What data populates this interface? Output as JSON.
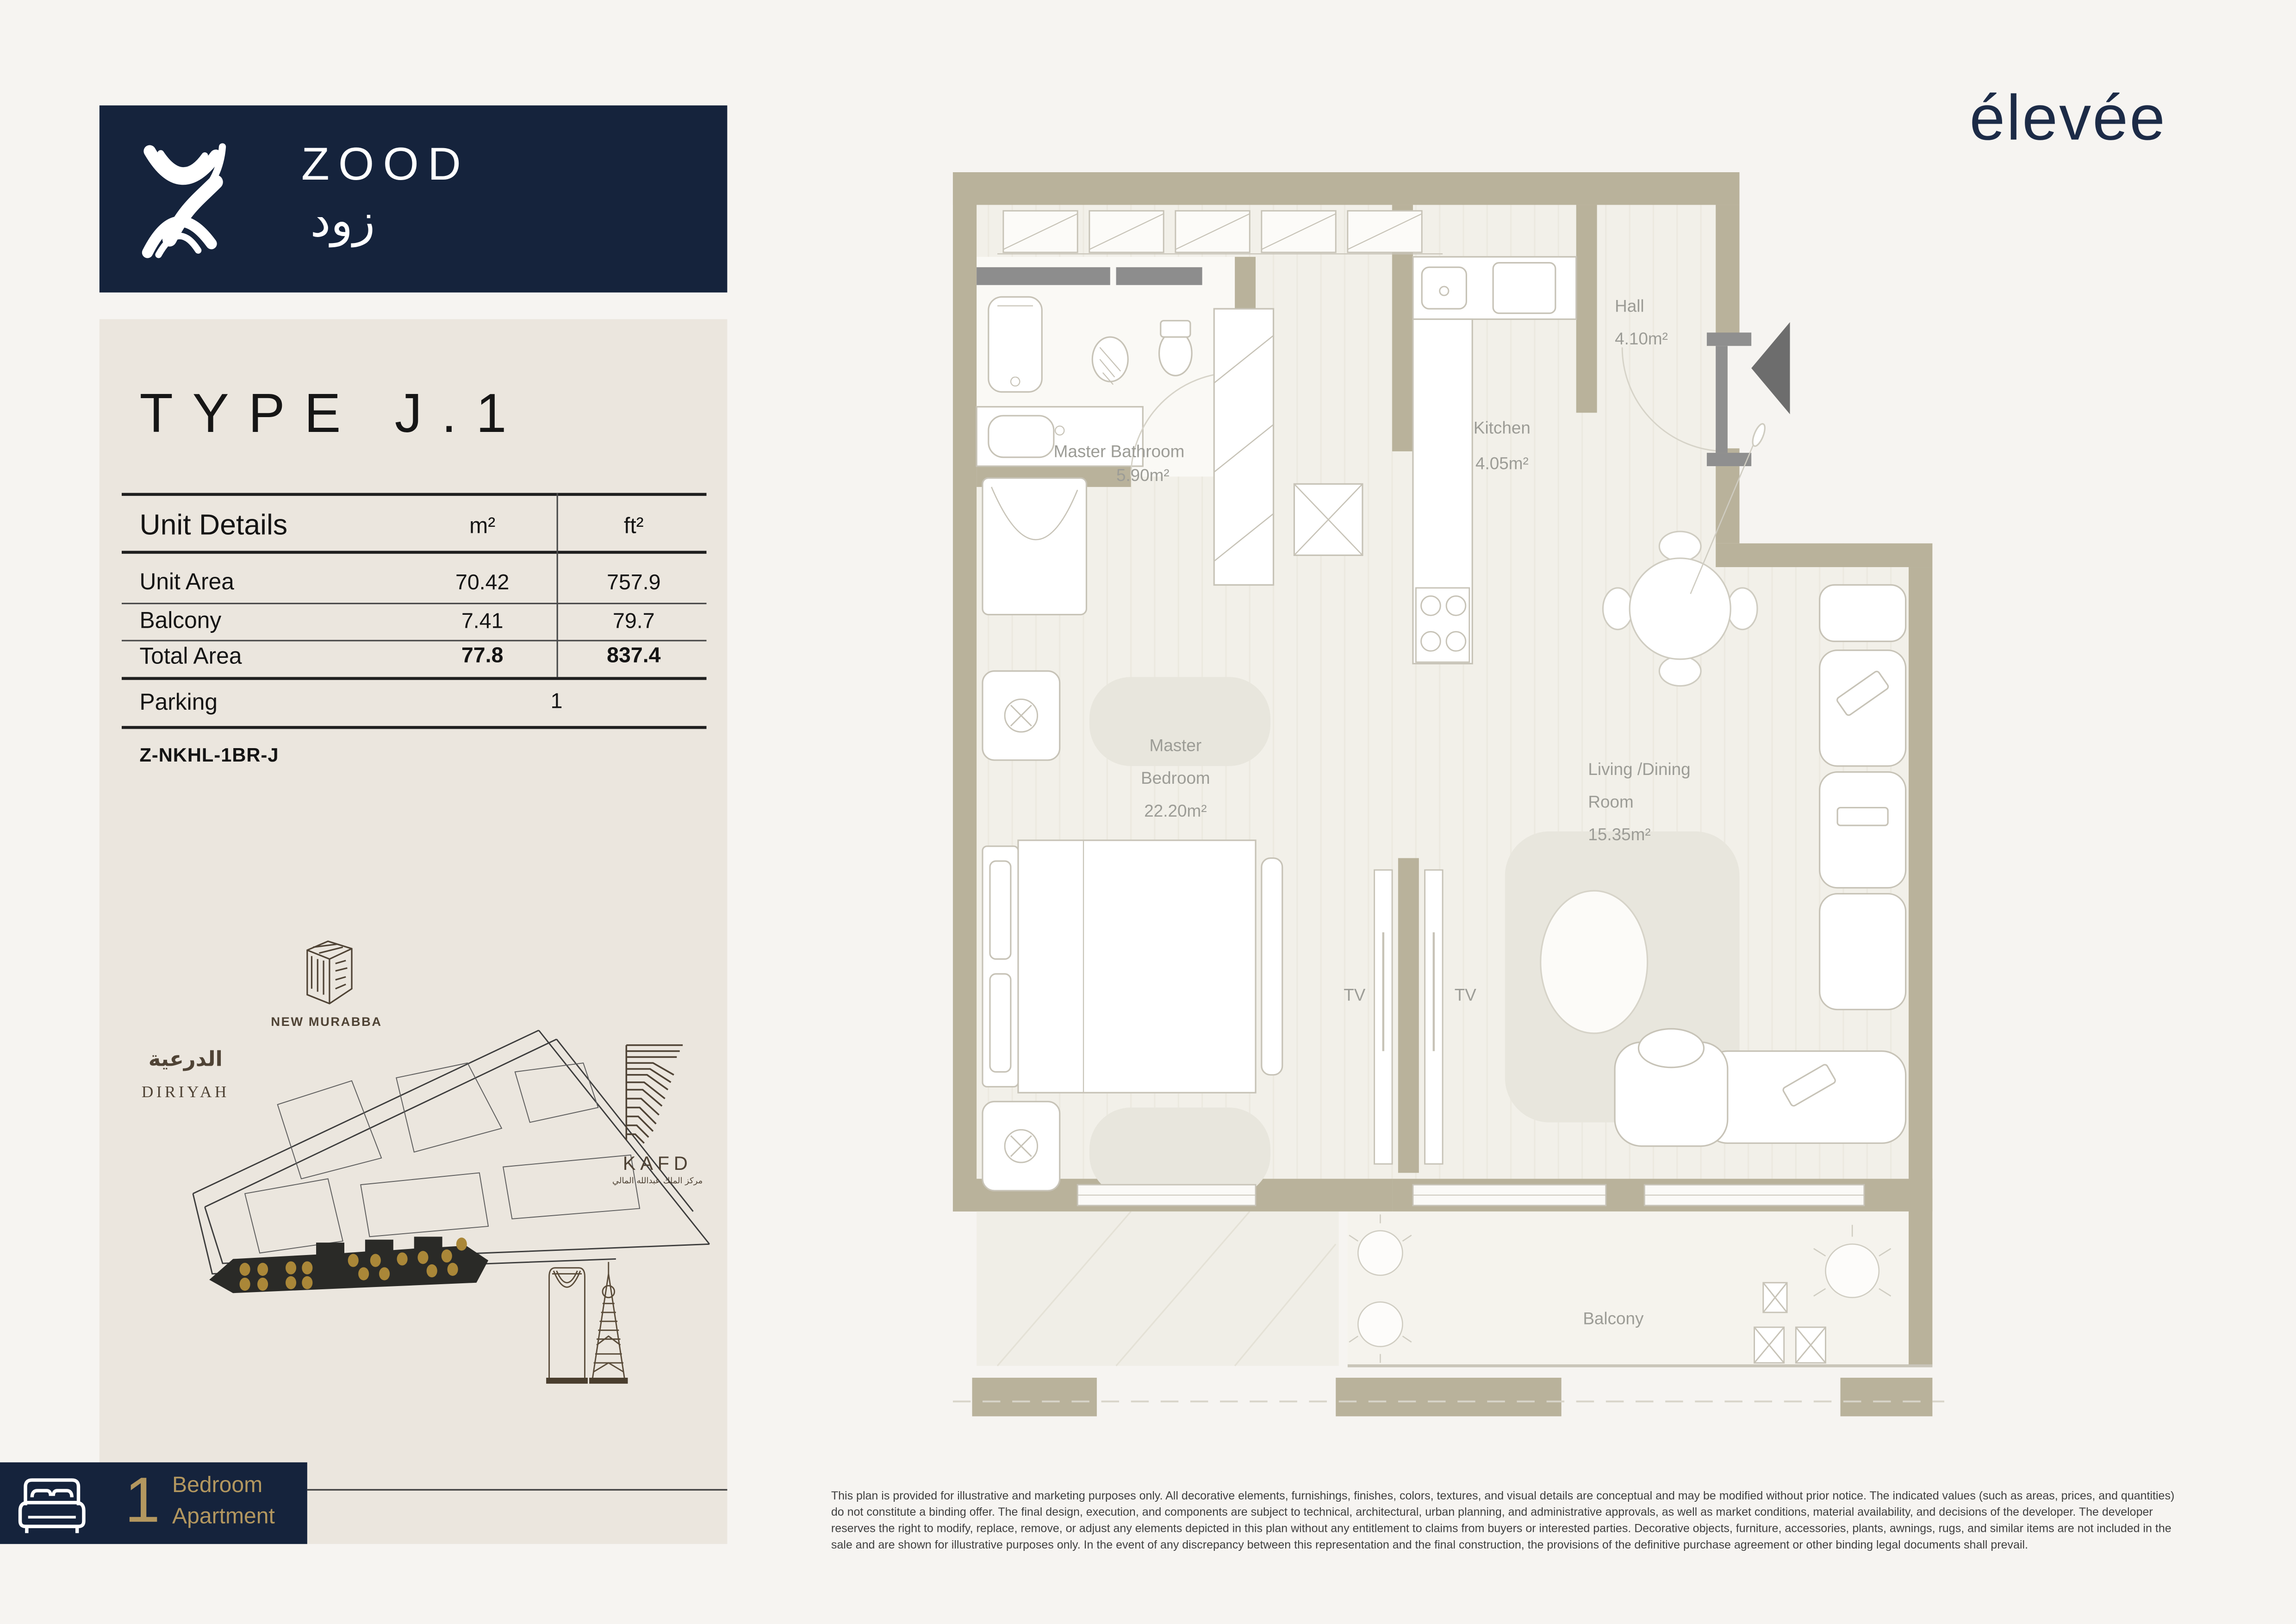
{
  "brand": {
    "logo_text": "ZOOD",
    "logo_text_ar": "زود",
    "partner_logo": "élevée",
    "navy": "#15233c",
    "gold": "#b3975f"
  },
  "panel": {
    "type_title": "TYPE J.1",
    "table": {
      "header_label": "Unit Details",
      "col_m2": "m²",
      "col_ft2": "ft²",
      "rows": [
        {
          "label": "Unit Area",
          "m2": "70.42",
          "ft2": "757.9"
        },
        {
          "label": "Balcony",
          "m2": "7.41",
          "ft2": "79.7"
        },
        {
          "label": "Total Area",
          "m2": "77.8",
          "ft2": "837.4"
        }
      ],
      "parking_label": "Parking",
      "parking_value": "1"
    },
    "unit_code": "Z-NKHL-1BR-J"
  },
  "map": {
    "new_murabba": "NEW MURABBA",
    "diriyah_ar": "الدرعية",
    "diriyah": "DIRIYAH",
    "kafd": "KAFD",
    "kafd_ar": "مركز الملك عبدالله المالي"
  },
  "floorplan": {
    "hall_name": "Hall",
    "hall_area": "4.10m²",
    "bathroom_name": "Master Bathroom",
    "bathroom_area": "5.90m²",
    "kitchen_name": "Kitchen",
    "kitchen_area": "4.05m²",
    "bedroom_line1": "Master",
    "bedroom_line2": "Bedroom",
    "bedroom_area": "22.20m²",
    "living_line1": "Living /Dining",
    "living_line2": "Room",
    "living_area": "15.35m²",
    "balcony_name": "Balcony",
    "tv": "TV"
  },
  "badge": {
    "count": "1",
    "line1": "Bedroom",
    "line2": "Apartment"
  },
  "disclaimer": "This plan is provided for illustrative and marketing purposes only. All decorative elements, furnishings, finishes, colors, textures, and visual details are conceptual and may be modified without prior notice. The indicated values (such as areas, prices, and quantities) do not constitute a binding offer. The final design, execution, and components are subject to technical, architectural, urban planning, and administrative approvals, as well as market conditions, material availability, and decisions of the developer. The developer reserves the right to modify, replace, remove, or adjust any elements depicted in this plan without any entitlement to claims from buyers or interested parties. Decorative objects, furniture, accessories, plants, awnings, rugs, and similar items are not included in the sale and are shown for illustrative purposes only. In the event of any discrepancy between this representation and the final construction, the provisions of the definitive purchase agreement or other binding legal documents shall prevail."
}
